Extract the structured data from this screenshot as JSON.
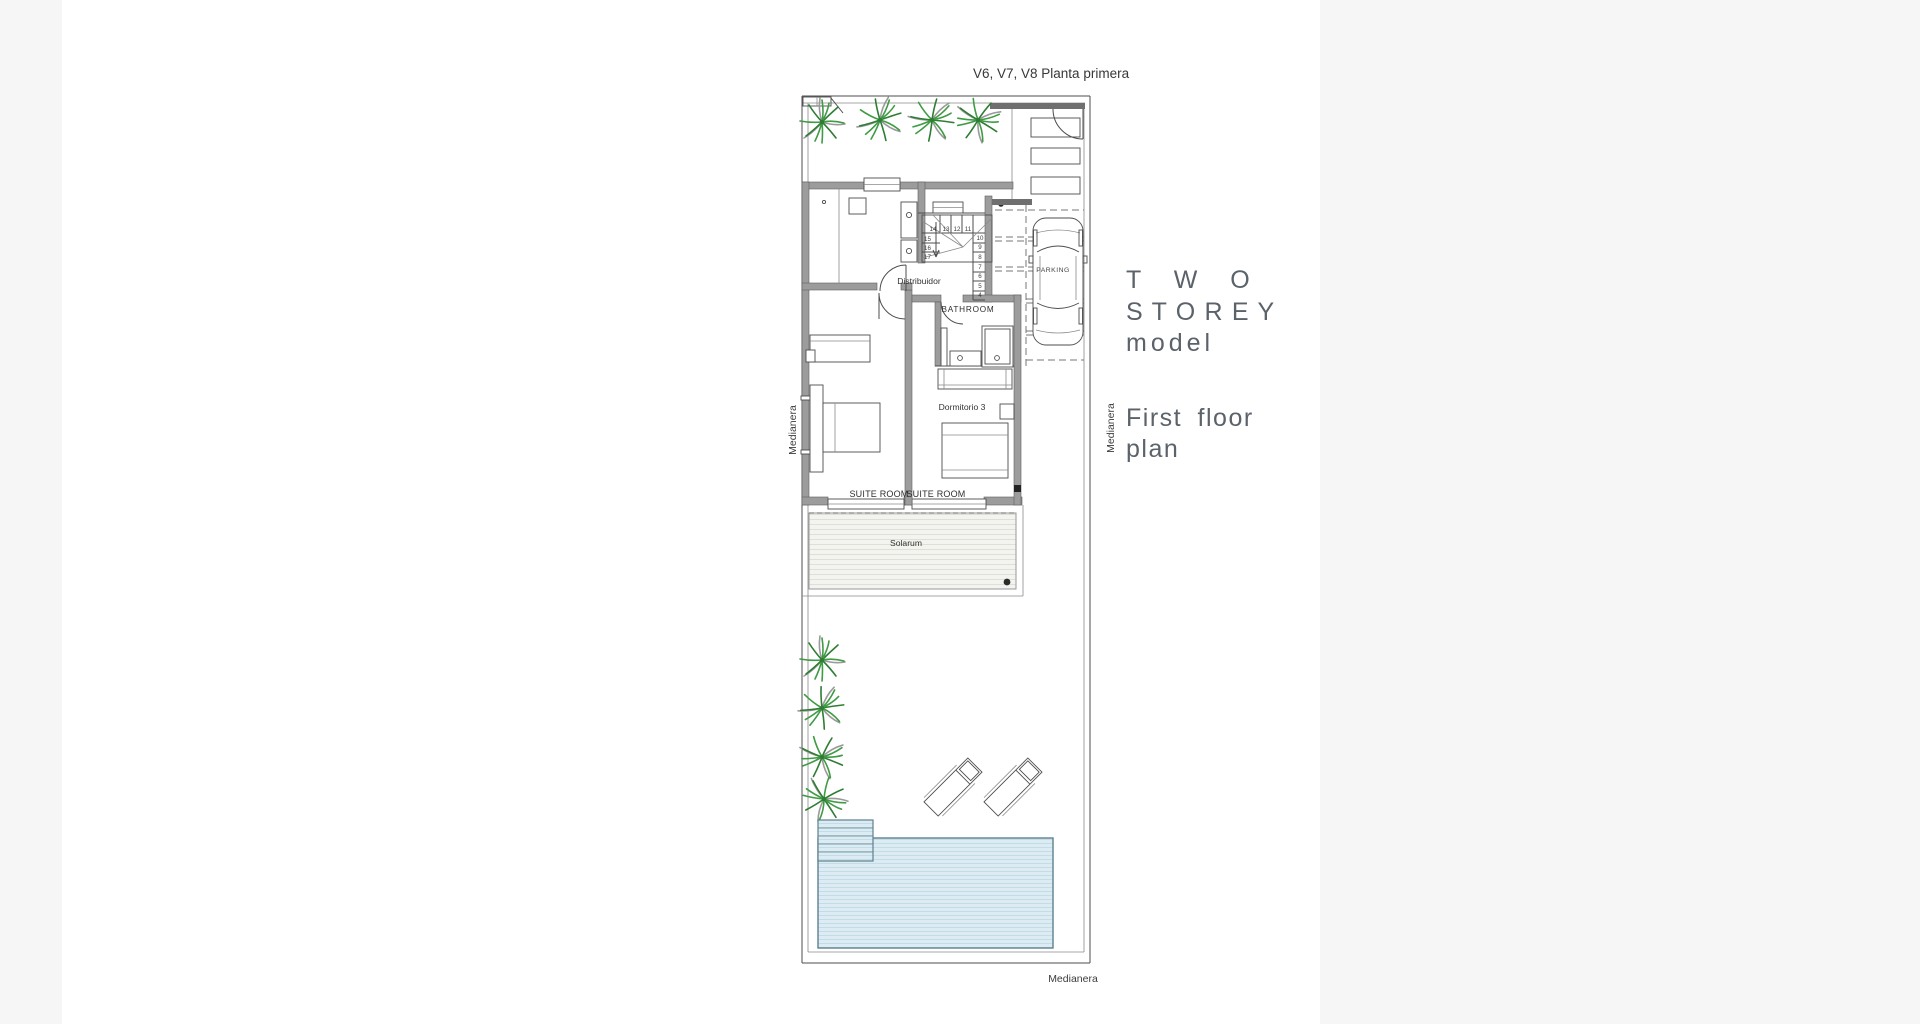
{
  "page": {
    "title": "V6, V7, V8 Planta primera"
  },
  "caption": {
    "two": "T W O",
    "storey": "S T O R E Y",
    "model": "model",
    "first_floor": "First floor",
    "plan": "plan"
  },
  "rooms": {
    "distribuidor": "Distribuidor",
    "bathroom": "BATHROOM",
    "dormitorio": "Dormitorio 3",
    "suite_left": "SUITE ROOM",
    "suite_right": "SUITE ROOM",
    "solarium": "Solarum",
    "parking": "PARKING"
  },
  "boundaries": {
    "left": "Medianera",
    "right": "Medianera",
    "bottom": "Medianera"
  },
  "stairs": {
    "top": [
      "14",
      "13",
      "12",
      "11"
    ],
    "left": [
      "15",
      "16",
      "17"
    ],
    "right": [
      "10",
      "9",
      "8",
      "7",
      "6",
      "5",
      "4"
    ]
  },
  "icons": {
    "tree": "palm-tree-icon",
    "car": "car-icon",
    "lounger": "sun-lounger-icon",
    "stair_arrow": "stair-direction-arrow",
    "entry_door": "door-swing-arc"
  },
  "colors": {
    "backdrop": "#f6f6f6",
    "paper": "#ffffff",
    "wall": "#9c9c9c",
    "wall_dark": "#6f6f6f",
    "line": "#4d4d4d",
    "text": "#3a3a3a",
    "caption": "#5b6269",
    "tree": "#3f9b44",
    "tree_dark": "#2e7d33",
    "pool_fill": "#dcecf2",
    "pool_stripe": "#c2dde7",
    "pool_border": "#5e808f",
    "deck_fill": "#f3f3ef",
    "deck_stripe": "#dedfd6"
  }
}
